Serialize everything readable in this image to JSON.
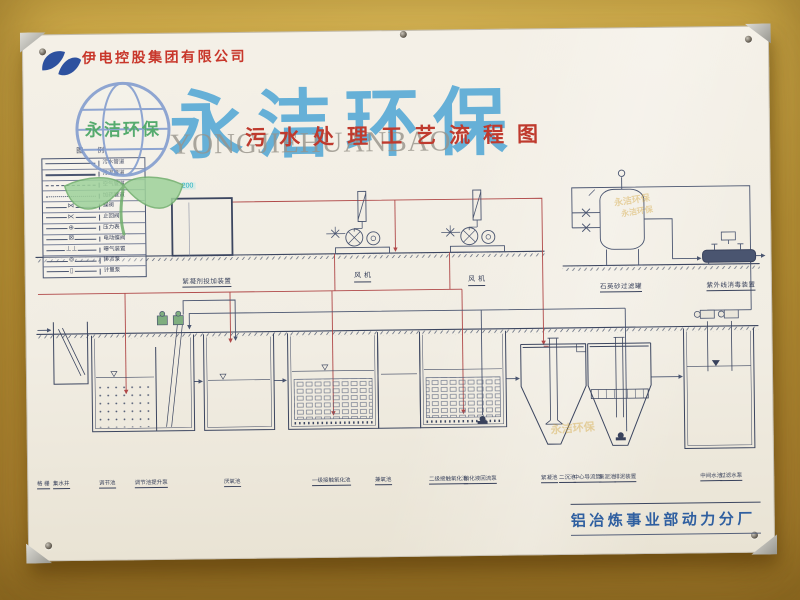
{
  "poster": {
    "company_name": "伊电控股集团有限公司",
    "title": "污水处理工艺流程图",
    "footer": "铝冶炼事业部动力分厂"
  },
  "watermark": {
    "main_text": "永洁环保",
    "latin_text": "YONGJIEHUANBAO",
    "logo_text": "永洁环保",
    "stamp_text": "永洁环保"
  },
  "legend": {
    "title": "图 例",
    "rows": [
      {
        "symbol": "sewage-line",
        "label": "污水管道"
      },
      {
        "symbol": "sludge-line",
        "label": "污泥管道"
      },
      {
        "symbol": "air-line",
        "label": "空气管道"
      },
      {
        "symbol": "dosing-line",
        "label": "加药管道"
      },
      {
        "symbol": "butterfly-valve",
        "label": "蝶阀"
      },
      {
        "symbol": "check-valve",
        "label": "止回阀"
      },
      {
        "symbol": "pressure-gauge",
        "label": "压力表"
      },
      {
        "symbol": "electric-valve",
        "label": "电动蝶阀"
      },
      {
        "symbol": "aerator",
        "label": "曝气装置"
      },
      {
        "symbol": "sewage-pump",
        "label": "排污泵"
      },
      {
        "symbol": "metering-pump",
        "label": "计量泵"
      }
    ]
  },
  "equipment": {
    "elevation_tag": "200",
    "dosing_device": "絮凝剂投加装置",
    "blower_left": "风 机",
    "blower_right": "风 机",
    "sand_filter": "石英砂过滤罐",
    "uv_disinfection": "紫外线消毒装置"
  },
  "tanks": [
    "格 栅",
    "集水井",
    "调节池",
    "调节池提升泵",
    "厌氧池",
    "一级接触氧化池",
    "兼氧池",
    "二级接触氧化池",
    "硝化液回流泵",
    "絮凝池",
    "二沉池",
    "中心导流筒",
    "集泥池",
    "排泥装置",
    "中间水池",
    "过滤水泵"
  ],
  "colors": {
    "wall_yellow": "#c9a23f",
    "title_red": "#bf3a2e",
    "company_red": "#c8372b",
    "footer_blue": "#2f5fa0",
    "diagram_ink": "#4a5570",
    "pipe_red": "#b04848",
    "watermark_blue": "#3f9fd4",
    "leaf_green": "#9ed29a",
    "latin_gray": "#97938a",
    "pump_green": "#7fae7f"
  }
}
